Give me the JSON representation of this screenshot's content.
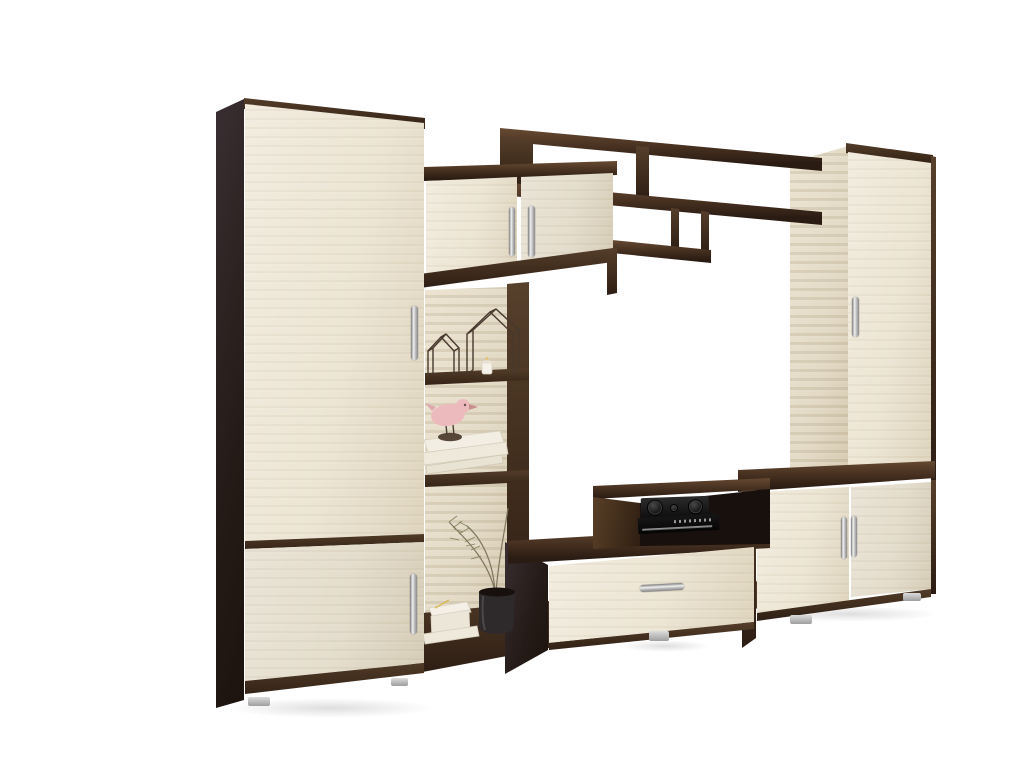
{
  "meta": {
    "title": "Wall unit furniture set product photo",
    "background": "#ffffff"
  },
  "palette": {
    "wenge-dark": "#2b1c13",
    "wenge-mid": "#44301f",
    "wenge-light": "#6b4e35",
    "cream": "#ece5d4",
    "cream-deep": "#ded4bd",
    "weave": "#e3dac6",
    "metal-light": "#f0f0f0",
    "metal-dark": "#7d7d7d",
    "bird-pink": "#ecb9bd",
    "vase": "#2e2a2b",
    "foliage": "#7d755c",
    "book": "#f3efe6",
    "interior-black": "#17100c",
    "bg": "#ffffff"
  },
  "furniture": {
    "style": "two-tone wenge brown and cream oak wall unit",
    "left_wardrobe": {
      "label": "left tall wardrobe",
      "doors": 2,
      "handles": 2
    },
    "display_cabinet": {
      "label": "upper two-door cabinet",
      "doors": 2,
      "handles": 2
    },
    "open_shelves": {
      "label": "open shelf column",
      "decor": [
        "wire house ornaments",
        "tea-light candle",
        "pink bird figurine on stand",
        "stacked white books",
        "white gift box",
        "dried plant in dark vase"
      ]
    },
    "wall_shelf": {
      "label": "wenge asymmetric wall shelf",
      "compartments": 4
    },
    "tv_stand": {
      "label": "TV stand with drawer",
      "handles": 1
    },
    "media_shelf": {
      "label": "media compartment",
      "equipment": [
        "stereo receiver with two knobs",
        "slim dvd player"
      ]
    },
    "lower_cabinet": {
      "label": "right two-door low cabinet",
      "doors": 2,
      "handles": 2
    },
    "right_wardrobe": {
      "label": "right tall wardrobe",
      "doors": 1,
      "handles": 1
    }
  }
}
